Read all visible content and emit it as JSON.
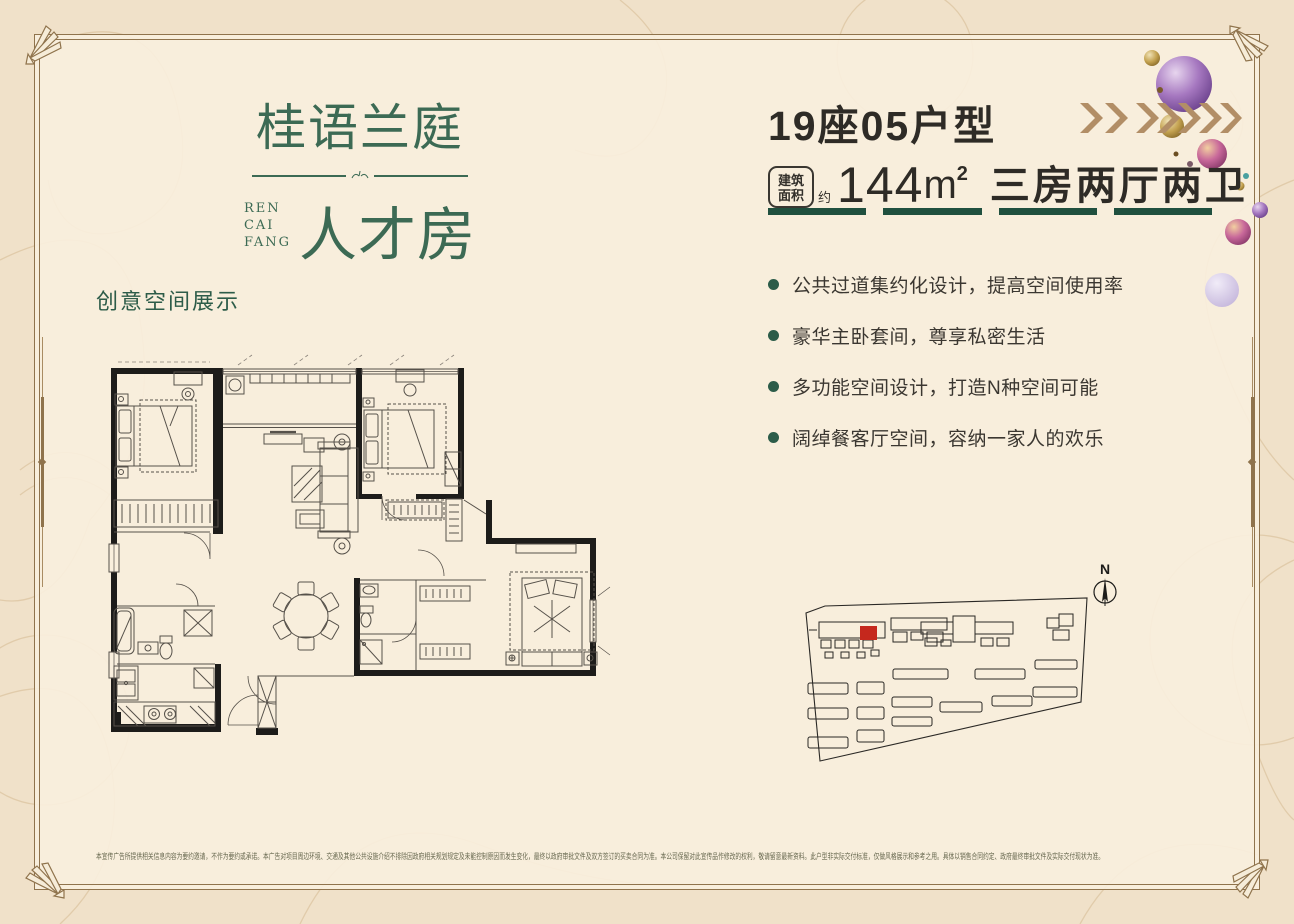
{
  "page": {
    "bg_outer": "#f0e1c9",
    "bg_panel": "#f9efdd",
    "frame_color": "#8f734c"
  },
  "logo": {
    "title": "桂语兰庭",
    "romanized_lines": [
      "REN",
      "CAI",
      "FANG"
    ],
    "subtitle": "人才房",
    "color": "#3c6a54"
  },
  "unit_header": {
    "title": "19座05户型",
    "badge_line1": "建筑",
    "badge_line2": "面积",
    "approx_label": "约",
    "area_number": "144",
    "area_unit": "m",
    "area_sup": "2",
    "layout_spec": "三房两厅两卫",
    "underline_color": "#20503f"
  },
  "features": {
    "bullet_color": "#2c5c49",
    "items": [
      "公共过道集约化设计，提高空间使用率",
      "豪华主卧套间，尊享私密生活",
      "多功能空间设计，打造N种空间可能",
      "阔绰餐客厅空间，容纳一家人的欢乐"
    ]
  },
  "floorplan_section": {
    "label": "创意空间展示"
  },
  "siteplan": {
    "north_label": "N",
    "highlight_color": "#c5281d"
  },
  "decor": {
    "arrow_color": "#b28e66",
    "sphere_colors": [
      "#9b6cb0",
      "#c9a84c",
      "#c8689a",
      "#d5c9e6"
    ]
  },
  "disclaimer": {
    "text": "本宣传广告所提供相关信息内容为要约邀请，不作为要约或承诺。本广告对项目周边环境、交通及其他公共设施介绍不排除因政府相关规划规定及未能控制原因而发生变化，最终以政府审批文件及双方签订的买卖合同为准。本公司保留对此宣传品作修改的权利，敬请留意最新资料。此户型非实际交付标准，仅做风格展示和参考之用。具体以销售合同约定、政府最终审批文件及实际交付现状为准。"
  }
}
